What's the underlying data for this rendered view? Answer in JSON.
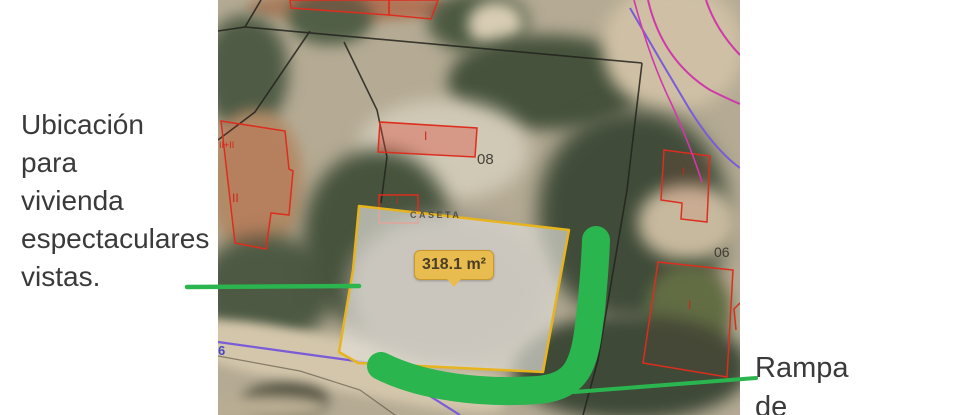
{
  "annotations": {
    "left": {
      "lines": {
        "0": "Ubicación",
        "1": "para",
        "2": "vivienda",
        "3": "espectaculares",
        "4": "vistas."
      }
    },
    "right": {
      "lines": {
        "0": "Rampa",
        "1": "de"
      }
    }
  },
  "map": {
    "area_tooltip": "318.1 m²",
    "caseta_label": "CASETA",
    "parcel_number_top": "08",
    "parcel_number_right": "06",
    "road_number": "6",
    "floors_left_top": "II+II",
    "floors_left": "II",
    "floors_center_building": "I",
    "floors_caseta": "I",
    "floors_right_building": "I",
    "floors_bottom_right": "I"
  },
  "colors": {
    "parcel_outline": "#e7b41e",
    "parcel_fill": "rgba(226,222,215,0.68)",
    "tooltip_bg": "#e9bc4f",
    "highlight_green": "#2ab54e",
    "cadastral_red": "#dd2d1e",
    "boundary_black": "#23231e",
    "road_purple": "#7a5cd8",
    "utility_magenta": "#cf3aaa",
    "annotation_text": "#3a3a3a"
  }
}
